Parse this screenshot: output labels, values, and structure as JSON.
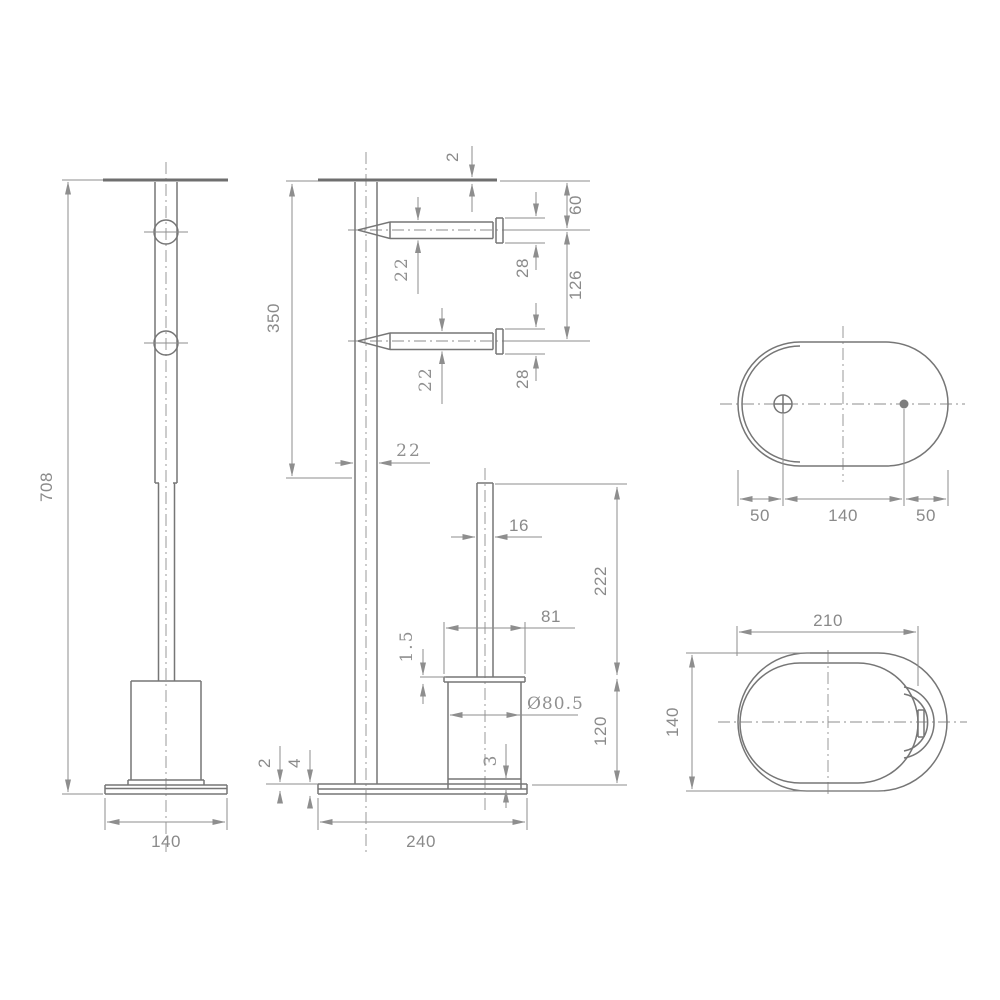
{
  "dims": {
    "front": {
      "height": "708",
      "base_width": "140"
    },
    "side": {
      "top_plate": "2",
      "upper_height": "350",
      "top_to_arm": "60",
      "arm1_tube": "22",
      "arm1_end": "28",
      "arm_spacing": "126",
      "arm2_tube": "22",
      "arm2_end": "28",
      "pole_width": "22",
      "handle_width": "16",
      "handle_height": "222",
      "cup_rim": "1.5",
      "cup_top_width": "81",
      "cup_diameter": "Ø80.5",
      "cup_foot": "3",
      "cup_height": "120",
      "base_sheet": "2",
      "base_thickness": "4",
      "base_length": "240"
    },
    "plate_top": {
      "left_offset": "50",
      "hole_spacing": "140",
      "right_offset": "50"
    },
    "cup_top": {
      "length": "210",
      "depth": "140"
    }
  },
  "colors": {
    "object_line": "#767676",
    "dimension_line": "#8e8e8e",
    "text": "#8a8a8a",
    "background": "#ffffff"
  }
}
